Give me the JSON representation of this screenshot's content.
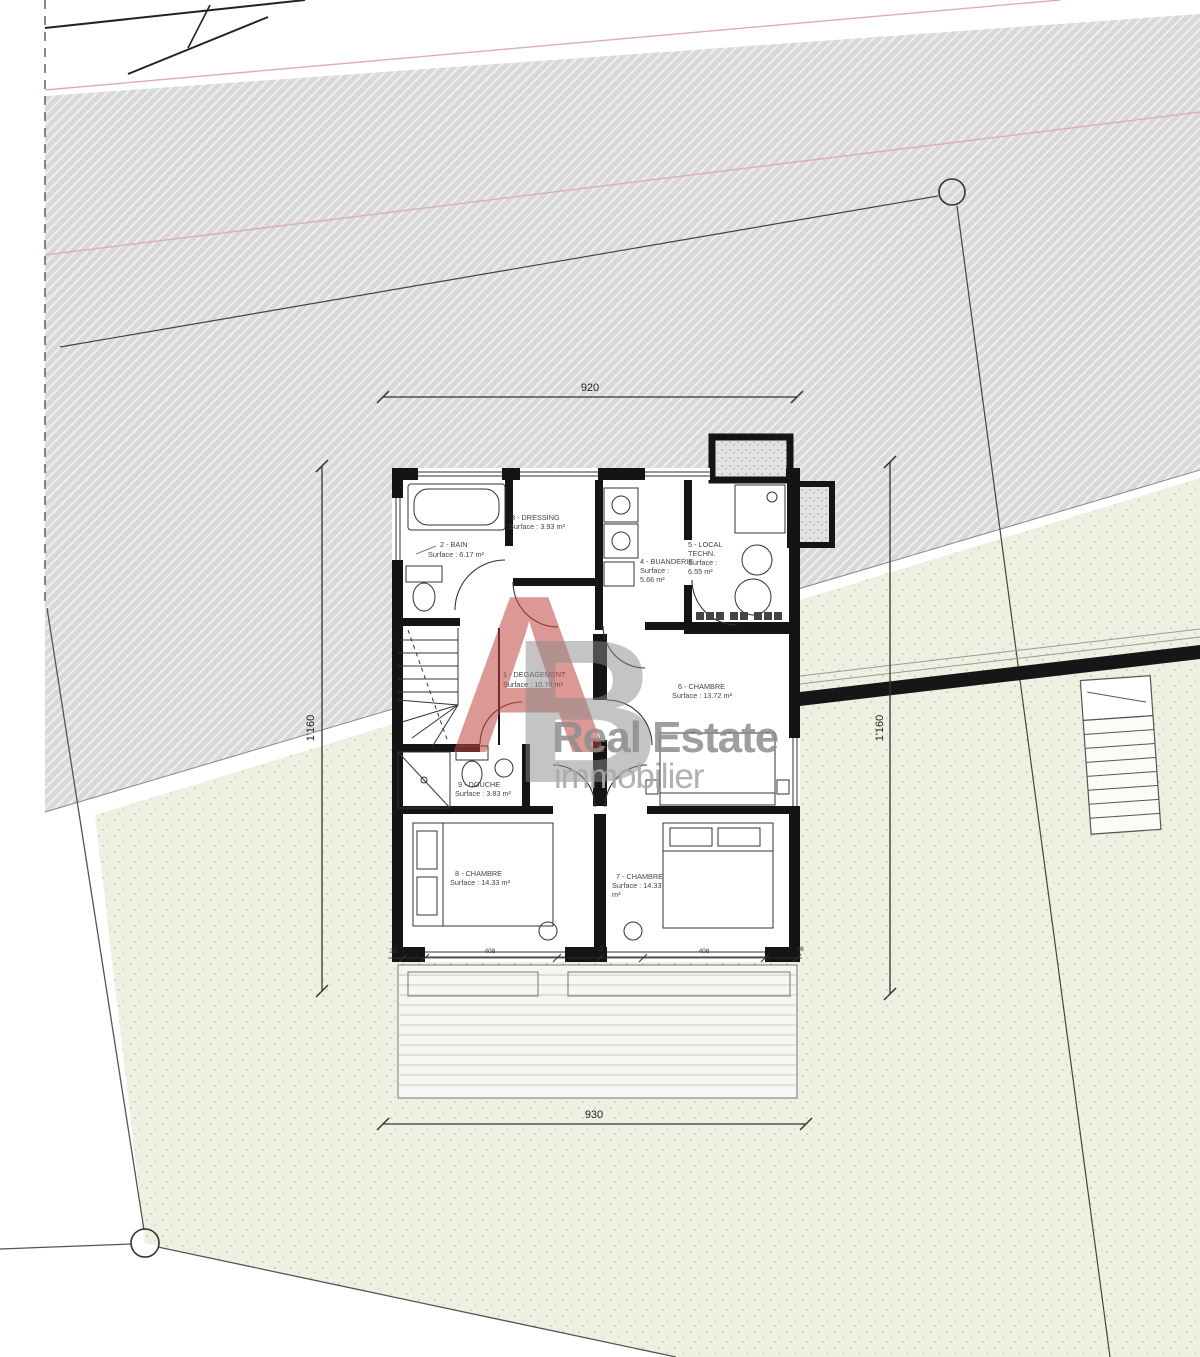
{
  "plan": {
    "rooms": [
      {
        "id": "1",
        "lines": [
          "1 - DEGAGEMENT",
          "Surface : 10.76 m²"
        ]
      },
      {
        "id": "2",
        "lines": [
          "2 - BAIN",
          "Surface : 6.17 m²"
        ]
      },
      {
        "id": "3",
        "lines": [
          "3 - DRESSING",
          "Surface : 3.93 m²"
        ]
      },
      {
        "id": "4",
        "lines": [
          "4 - BUANDERIE",
          "Surface :",
          "5.66 m²"
        ]
      },
      {
        "id": "5",
        "lines": [
          "5 - LOCAL",
          "TECHN.",
          "Surface :",
          "6.55 m²"
        ]
      },
      {
        "id": "6",
        "lines": [
          "6 - CHAMBRE",
          "Surface : 13.72 m²"
        ]
      },
      {
        "id": "7",
        "lines": [
          "7 - CHAMBRE",
          "Surface : 14.33",
          "m²"
        ]
      },
      {
        "id": "8",
        "lines": [
          "8 - CHAMBRE",
          "Surface : 14.33 m²"
        ]
      },
      {
        "id": "9",
        "lines": [
          "9 - DOUCHE",
          "Surface : 3.83 m²"
        ]
      }
    ],
    "dimensions": {
      "top": "920",
      "bottom": "930",
      "left": "1'160",
      "right": "1'160",
      "bottom_segments": [
        "28",
        "408",
        "15",
        "408",
        "36"
      ]
    },
    "watermark": {
      "letter_a": "A",
      "letter_b": "B",
      "line1": "Real Estate",
      "line2": "immobilier",
      "red": "#c0443c",
      "gray": "#8d8d8d"
    },
    "colors": {
      "wall": "#141414",
      "site_gray": "#d8d8d8",
      "site_green": "#eef0e1",
      "boundary_pink": "#d9aebb"
    }
  }
}
